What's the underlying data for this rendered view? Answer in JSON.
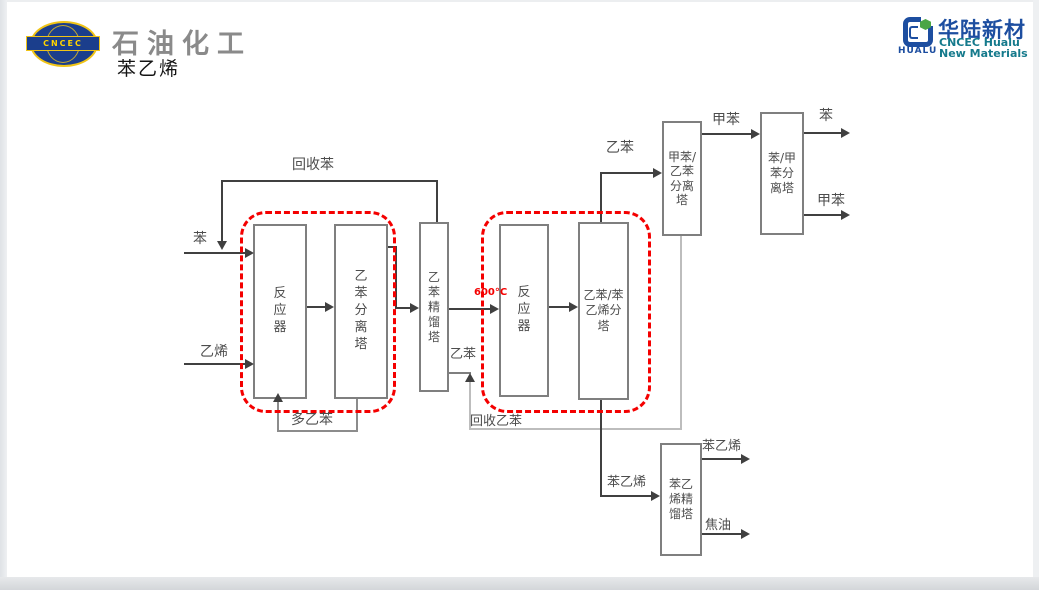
{
  "header": {
    "cncec_logo_text": "CNCEC",
    "brand_title": "石油化工",
    "page_title": "苯乙烯",
    "hualu": {
      "logo_text": "HUALU",
      "name_cn": "华陆新材",
      "name_en_line1": "CNCEC Hualu",
      "name_en_line2": "New Materials"
    }
  },
  "colors": {
    "red_dashed": "#f40000",
    "flow_line": "#404040",
    "recycle_line": "#bdbdbd",
    "box_border": "#7f7f7f",
    "cncec_blue": "#1b3e8c",
    "cncec_yellow": "#f0c417",
    "hualu_blue": "#1d4ea0",
    "hualu_teal": "#157a8c",
    "hexagon_green": "#4aa546"
  },
  "diagram": {
    "boxes": {
      "reactor_1": "反\n应\n器",
      "eb_separation_tower": "乙\n苯\n分\n离\n塔",
      "eb_distillation_tower": "乙\n苯\n精\n馏\n塔",
      "reactor_2": "反\n应\n器",
      "eb_styrene_separation_tower": "乙苯/苯\n乙烯分\n塔",
      "toluene_eb_separation_tower": "甲苯/\n乙苯\n分离\n塔",
      "benzene_toluene_separation_tower": "苯/甲\n苯分\n离塔",
      "styrene_distillation_tower": "苯乙\n烯精\n馏塔"
    },
    "labels": {
      "benzene_feed": "苯",
      "ethylene_feed": "乙烯",
      "recycled_benzene": "回收苯",
      "poly_ethylbenzene": "多乙苯",
      "ethylbenzene_mid": "乙苯",
      "temperature": "600°C",
      "recycled_ethylbenzene": "回收乙苯",
      "ethylbenzene_top": "乙苯",
      "toluene_mid": "甲苯",
      "benzene_out": "苯",
      "toluene_out": "甲苯",
      "styrene_feed": "苯乙烯",
      "styrene_out": "苯乙烯",
      "tar_out": "焦油"
    }
  }
}
